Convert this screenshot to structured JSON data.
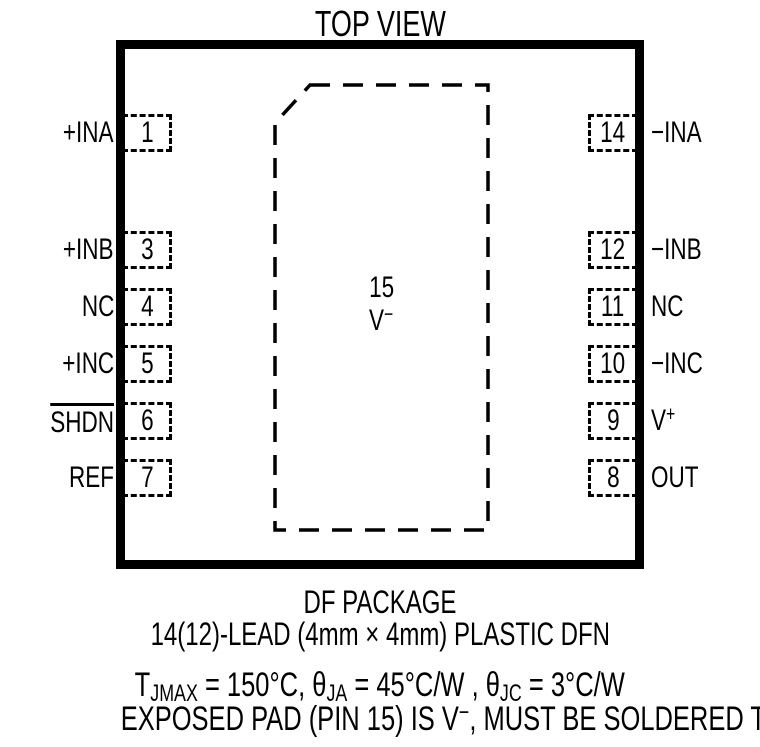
{
  "title": "TOP VIEW",
  "colors": {
    "ink": "#000000",
    "background": "#ffffff"
  },
  "package": {
    "pad": {
      "pin_number": "15",
      "label_text": "V",
      "label_sup": "−"
    },
    "pins_left": [
      {
        "number": "1",
        "label": "+INA"
      },
      {
        "number": "3",
        "label": "+INB"
      },
      {
        "number": "4",
        "label": "NC"
      },
      {
        "number": "5",
        "label": "+INC"
      },
      {
        "number": "6",
        "label": "SHDN",
        "overline": true
      },
      {
        "number": "7",
        "label": "REF"
      }
    ],
    "pins_right": [
      {
        "number": "14",
        "label": "−INA"
      },
      {
        "number": "12",
        "label": "−INB"
      },
      {
        "number": "11",
        "label": "NC"
      },
      {
        "number": "10",
        "label": "−INC"
      },
      {
        "number": "9",
        "label": "V",
        "sup": "+"
      },
      {
        "number": "8",
        "label": "OUT"
      }
    ]
  },
  "captions": {
    "package_name": "DF PACKAGE",
    "package_desc": "14(12)-LEAD (4mm × 4mm) PLASTIC DFN",
    "thermal": {
      "t": "T",
      "t_sub": "JMAX",
      "seg1": " = 150°C, ",
      "theta1": "θ",
      "theta1_sub": "JA",
      "seg2": " = 45°C/W , ",
      "theta2": "θ",
      "theta2_sub": "JC",
      "seg3": " = 3°C/W"
    },
    "exposed": {
      "pre": "EXPOSED PAD (PIN 15) IS V",
      "sup": "−",
      "post": ", MUST BE SOLDERED TO PCB"
    }
  }
}
